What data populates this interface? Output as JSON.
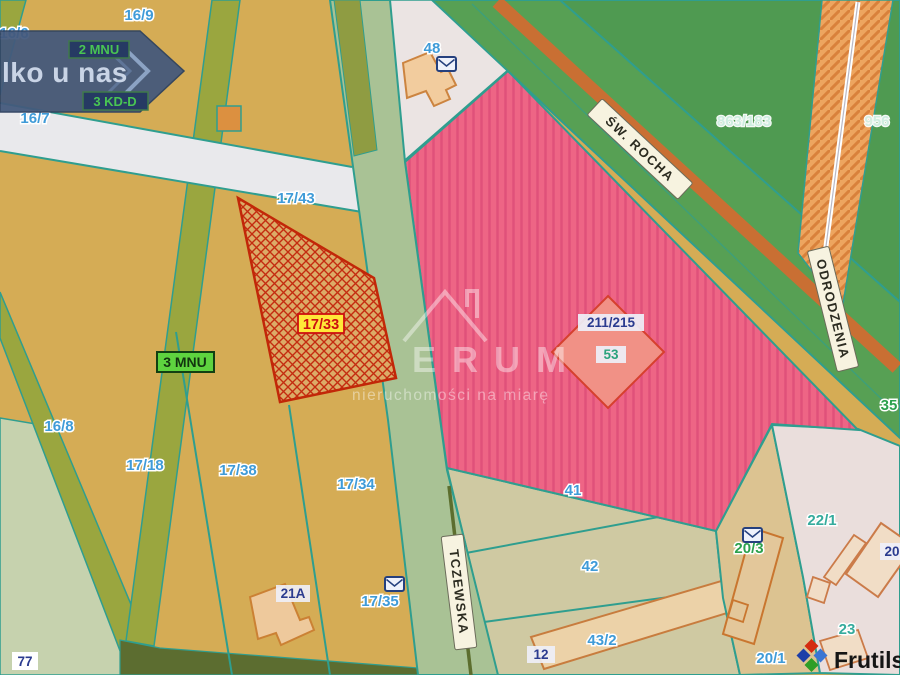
{
  "map": {
    "streets": {
      "tczewska": "TCZEWSKA",
      "sw_rocha": "ŚW. ROCHA",
      "odrodzenia": "ODRODZENIA"
    },
    "zones": {
      "mnu2": "2 MNU",
      "kdd3": "3 KD-D",
      "mnu3": "3 MNU"
    },
    "parcels": {
      "p16_6": "16/6",
      "p16_9": "16/9",
      "p16_7": "16/7",
      "p17_43": "17/43",
      "p17_33": "17/33",
      "p16_8": "16/8",
      "p17_18": "17/18",
      "p17_38": "17/38",
      "p17_34": "17/34",
      "p17_35": "17/35",
      "p21a": "21A",
      "p77": "77",
      "p48": "48",
      "p41": "41",
      "p42": "42",
      "p43_2": "43/2",
      "p12": "12",
      "p211_215": "211/215",
      "p53": "53",
      "p863_183": "863/183",
      "p956": "956",
      "p35": "35",
      "p22_1": "22/1",
      "p20_3": "20/3",
      "p20": "20",
      "p23": "23",
      "p20_1": "20/1"
    },
    "colors": {
      "base_land": "#d5ac55",
      "highlight_parcel_hatch": "#c42c10",
      "offer_area_pink": "#ee6585",
      "forest_green": "#4f9a51",
      "road_orange": "#eda55f",
      "road_sage": "#a9c295",
      "border_teal": "#2f9e8f",
      "label_yellow": "#ffe838"
    }
  },
  "banner": {
    "text": "lko u nas"
  },
  "watermark": {
    "brand": "ERUM",
    "tagline": "nieruchomości na miarę"
  },
  "logo": {
    "text": "Frutils"
  }
}
